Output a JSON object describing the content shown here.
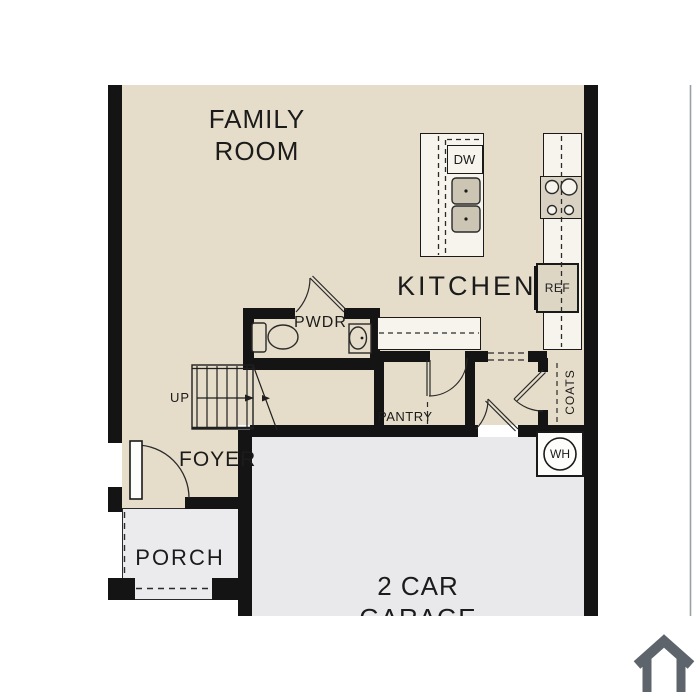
{
  "palette": {
    "background": "#ffffff",
    "floor_beige": "#e5ddc9",
    "garage_gray": "#e9e9eb",
    "porch_gray": "#ebebed",
    "wall_black": "#141414",
    "counter_white": "#f6f4ec",
    "appliance_tan": "#d9d2c2",
    "line_dark": "#2a2a2a",
    "house_icon_gray": "#5d646b",
    "carousel_edge_gray": "#9aa0a4"
  },
  "rooms": {
    "family_room": {
      "line1": "FAMILY",
      "line2": "ROOM"
    },
    "kitchen": {
      "label": "KITCHEN"
    },
    "powder": {
      "label": "PWDR"
    },
    "foyer": {
      "label": "FOYER"
    },
    "pantry": {
      "label": "PANTRY"
    },
    "coats": {
      "label": "COATS"
    },
    "porch": {
      "label": "PORCH"
    },
    "garage": {
      "line1": "2 CAR",
      "line2": "GARAGE"
    }
  },
  "fixtures": {
    "dishwasher": "DW",
    "refrigerator": "REF",
    "water_heater": "WH",
    "stair_direction": "UP"
  },
  "icons": {
    "house_watermark": "house-icon"
  }
}
